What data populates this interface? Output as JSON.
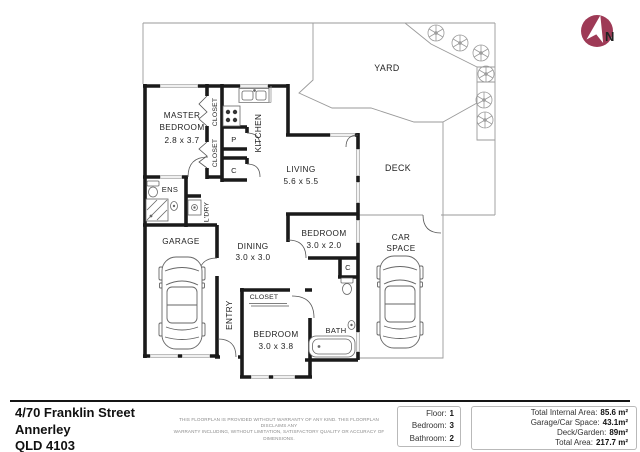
{
  "compass": {
    "north": "N"
  },
  "plan": {
    "yard": "YARD",
    "deck": "DECK",
    "master_line1": "MASTER",
    "master_line2": "BEDROOM",
    "master_dims": "2.8 x 3.7",
    "closet_top": "CLOSET",
    "closet_mid": "CLOSET",
    "closet_entry": "CLOSET",
    "kitchen": "KITCHEN",
    "pantry": "P",
    "cupboard_kitchen": "C",
    "cupboard_bedroom": "C",
    "living": "LIVING",
    "living_dims": "5.6 x 5.5",
    "ens": "ENS",
    "laundry": "L'DRY",
    "garage": "GARAGE",
    "dining": "DINING",
    "dining_dims": "3.0 x 3.0",
    "bedroom_mid": "BEDROOM",
    "bedroom_mid_dims": "3.0 x 2.0",
    "car_space_line1": "CAR",
    "car_space_line2": "SPACE",
    "entry": "ENTRY",
    "bedroom_front": "BEDROOM",
    "bedroom_front_dims": "3.0 x 3.8",
    "bath": "BATH"
  },
  "address": {
    "line1": "4/70 Franklin Street",
    "line2": "Annerley",
    "line3": "QLD 4103"
  },
  "disclaimer": {
    "line1": "THIS FLOORPLAN IS PROVIDED WITHOUT WARRANTY OF ANY KIND. THIS FLOORPLAN DISCLAIMS ANY",
    "line2": "WARRANTY INCLUDING, WITHOUT LIMITATION, SATISFACTORY QUALITY OR ACCURACY OF DIMENSIONS."
  },
  "stats": {
    "rows": [
      {
        "label": "Floor:",
        "value": "1"
      },
      {
        "label": "Bedroom:",
        "value": "3"
      },
      {
        "label": "Bathroom:",
        "value": "2"
      }
    ]
  },
  "areas": {
    "rows": [
      {
        "label": "Total Internal Area:",
        "value": "85.6 m²"
      },
      {
        "label": "Garage/Car Space:",
        "value": "43.1m²"
      },
      {
        "label": "Deck/Garden:",
        "value": "89m²"
      },
      {
        "label": "Total Area:",
        "value": "217.7 m²"
      }
    ]
  },
  "colors": {
    "compass": "#9e3a56",
    "wall": "#1a1a1a",
    "thin_line": "#9a9a9a",
    "window": "#c4c4c4"
  }
}
